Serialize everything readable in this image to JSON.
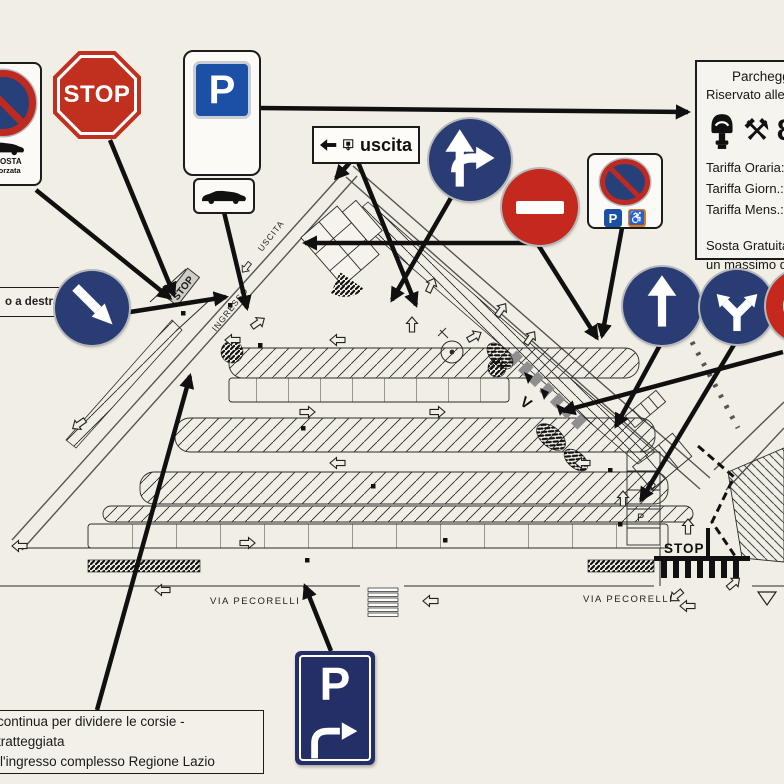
{
  "colors": {
    "paper": "#f1eee5",
    "sign_blue_circle": "#2a3c74",
    "sign_blue_square": "#1c4fa6",
    "sign_red": "#c1301f",
    "ink": "#161616"
  },
  "signs": {
    "no_parking_panel": {
      "line1": "DI SOSTA",
      "line2": "ne forzata"
    },
    "stop": {
      "label": "STOP"
    },
    "parking_main": {
      "label": "P"
    },
    "uscita_sign": {
      "label": "uscita"
    },
    "disabled_parking": {
      "p": "P",
      "wheelchair": "♿"
    },
    "parking_turn": {
      "label": "P"
    },
    "a_destra": {
      "label": "o a destra"
    }
  },
  "tariff_panel": {
    "title": "Parcheggio",
    "subtitle": "Riservato alle",
    "icon_hammers": "⚒",
    "icon_partial": "8",
    "rows": [
      "Tariffa Oraria:",
      "Tariffa Giorn.:",
      "Tariffa Mens.:"
    ],
    "note_line1": "Sosta Gratuita",
    "note_line2": "un massimo di"
  },
  "note_box": {
    "line1": "continua per dividere le corsie - tratteggiata",
    "line2": "ll'ingresso complesso Regione Lazio"
  },
  "map_labels": {
    "via_pecorelli_left": "VIA PECORELLI",
    "via_pecorelli_right": "VIA PECORELLI",
    "uscita_lane": "USCITA",
    "ingresso_lane": "INGRESSO",
    "stop_road": "STOP",
    "stop_bottom": "STOP",
    "p1": "P",
    "p2": "P",
    "yield_v": "V"
  }
}
